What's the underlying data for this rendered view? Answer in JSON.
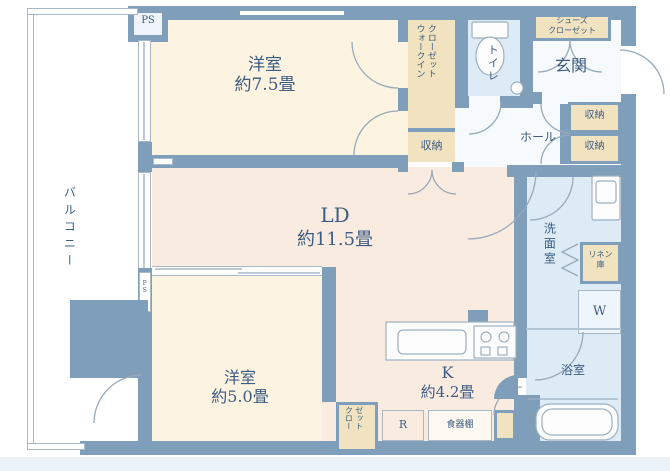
{
  "title": "マンション間取り図",
  "colors": {
    "wall": "#7f9eba",
    "bedroom_cream": "#fcf3e1",
    "living_peach": "#faebe0",
    "wet_area_blue": "#dcebf5",
    "closet_tan": "#f1e3bf",
    "hall_white": "#f6fafc",
    "text_navy": "#3d5c82",
    "margin_band": "#eaf2f8"
  },
  "labels": {
    "ps_top": "PS",
    "ps_side": "PS",
    "balcony": "バルコニー",
    "bedroom1_name": "洋室",
    "bedroom1_size": "約7.5畳",
    "wic_line1": "ウォークイン",
    "wic_line2": "クローゼット",
    "wic_storage": "収納",
    "toilet": "トイレ",
    "shoes_line1": "シューズ",
    "shoes_line2": "クローゼット",
    "entrance": "玄関",
    "hall": "ホール",
    "hall_storage_1": "収納",
    "hall_storage_2": "収納",
    "living_name": "LD",
    "living_size": "約11.5畳",
    "washroom": "洗面室",
    "linen_line1": "リネン",
    "linen_line2": "庫",
    "washer": "W",
    "bath": "浴室",
    "bedroom2_name": "洋室",
    "bedroom2_size": "約5.0畳",
    "kitchen_name": "K",
    "kitchen_size": "約4.2畳",
    "closet_line1": "クロー",
    "closet_line2": "ゼット",
    "fridge": "R",
    "cupboard": "食器棚"
  },
  "rooms": [
    {
      "name": "洋室",
      "size_tatami": 7.5
    },
    {
      "name": "LD",
      "size_tatami": 11.5
    },
    {
      "name": "洋室",
      "size_tatami": 5.0
    },
    {
      "name": "K",
      "size_tatami": 4.2
    }
  ]
}
